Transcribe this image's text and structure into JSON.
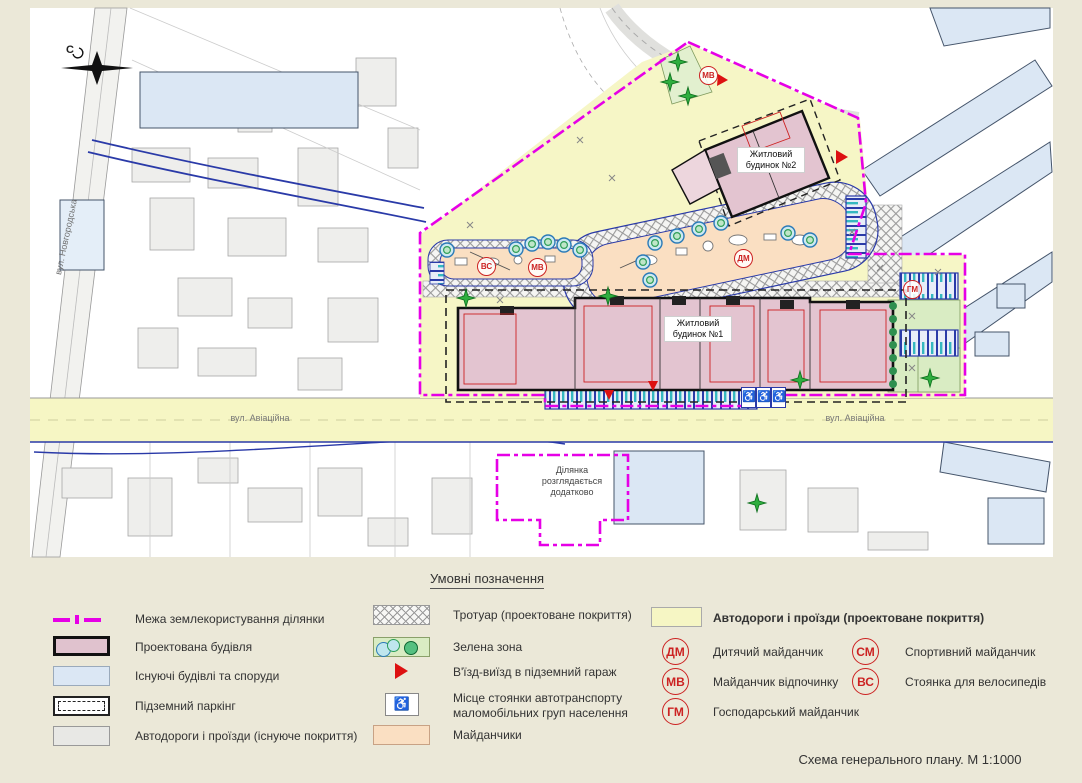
{
  "colors": {
    "page_bg": "#ebe8d8",
    "sheet_bg": "#ffffff",
    "site_boundary_magenta": "#e600e6",
    "proposed_building_pink": "#e3c4d0",
    "existing_building_blue": "#dbe7f4",
    "road_proposed_yellow": "#f6f6c4",
    "road_existing_gray": "#e8e8e5",
    "green_zone": "#d9ecc3",
    "playground_peach": "#fadfc2",
    "marker_red": "#cc2222",
    "utility_blue": "#2a3aa8"
  },
  "map": {
    "compass_letter": "С",
    "street_novhorodska": "вул. Новгородська",
    "street_aviatsiina": "вул. Авіаційна",
    "building_1_label": "Житловий будинок №1",
    "building_2_label": "Житловий будинок №2",
    "area_note": "Ділянка розглядається додатково",
    "badges": [
      {
        "code": "ДМ"
      },
      {
        "code": "МВ"
      },
      {
        "code": "ВС"
      },
      {
        "code": "ГМ"
      },
      {
        "code": "МВ"
      }
    ],
    "wheelchair_symbol": "♿"
  },
  "legend": {
    "title": "Умовні позначення",
    "col1": [
      {
        "label": "Межа землекористування ділянки"
      },
      {
        "label": "Проектована будівля"
      },
      {
        "label": "Існуючі будівлі та споруди"
      },
      {
        "label": "Підземний паркінг"
      },
      {
        "label": "Автодороги і проїзди (існуюче покриття)"
      }
    ],
    "col2": [
      {
        "label": "Тротуар (проектоване покриття)"
      },
      {
        "label": "Зелена зона"
      },
      {
        "label": "В'їзд-виїзд в підземний гараж"
      },
      {
        "label": "Місце стоянки автотранспорту маломобільних груп населення"
      },
      {
        "label": "Майданчики"
      }
    ],
    "col3_header": "Автодороги і проїзди (проектоване покриття)",
    "col3": [
      {
        "code": "ДМ",
        "label": "Дитячий майданчик"
      },
      {
        "code": "МВ",
        "label": "Майданчик відпочинку"
      },
      {
        "code": "ГМ",
        "label": "Господарський майданчик"
      }
    ],
    "col4": [
      {
        "code": "СМ",
        "label": "Спортивний майданчик"
      },
      {
        "code": "ВС",
        "label": "Стоянка для велосипедів"
      }
    ]
  },
  "footer": {
    "title": "Схема  генерального плану. М 1:1000"
  }
}
